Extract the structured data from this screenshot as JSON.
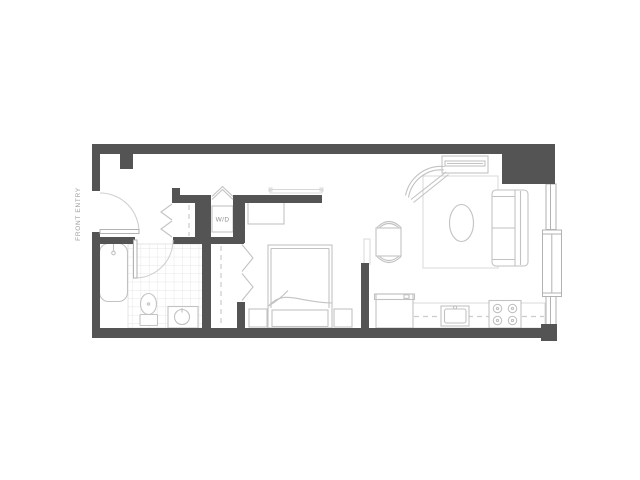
{
  "floor_plan": {
    "labels": {
      "front_entry": "FRONT ENTRY",
      "washer_dryer": "W/D"
    },
    "colors": {
      "wall": "#545454",
      "furniture_line": "#c2c2c2",
      "light_line": "#d8d8d8",
      "tile_line": "#e6e6e6",
      "dashed_line": "#cccccc",
      "window_line": "#b2b2b2",
      "door_arc": "#cfcfcf",
      "label_text": "#9e9e9e",
      "background": "#ffffff"
    },
    "elements": [
      "entry-door",
      "coat-closet",
      "washer-dryer-closet",
      "bathroom-bathtub",
      "bathroom-toilet",
      "bathroom-vanity-sink",
      "bedroom-closet-bifold",
      "bedroom-dresser",
      "bedroom-wall-shelf",
      "bedroom-bed",
      "nightstands",
      "dining-table-with-chairs",
      "media-console-tv",
      "armchair",
      "area-rug",
      "oval-coffee-table",
      "sofa",
      "refrigerator",
      "kitchen-counter",
      "kitchen-sink",
      "cooktop-4-burners",
      "balcony-window-door"
    ]
  }
}
